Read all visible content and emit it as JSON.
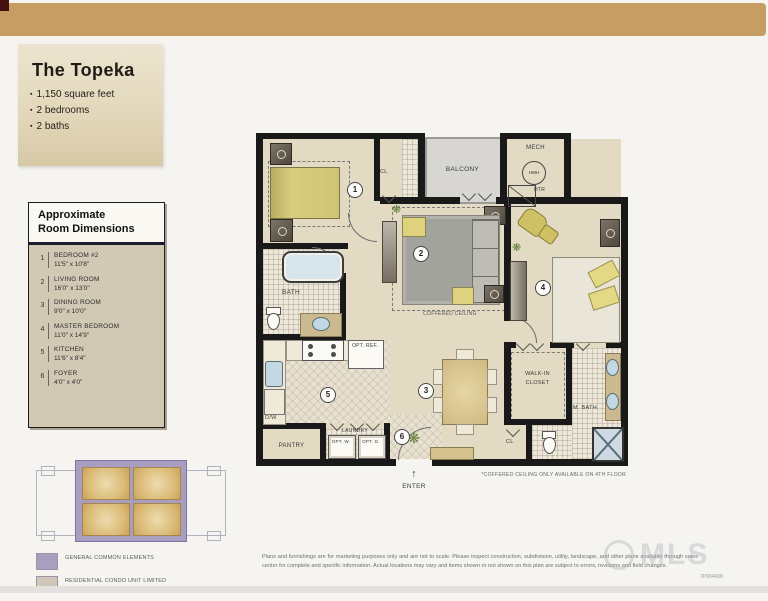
{
  "page": {
    "top_bar_color": "#c69e63",
    "watermark": "MLS",
    "doc_code": "7P904668"
  },
  "title_block": {
    "title": "The Topeka",
    "bullet_glyph": "▪",
    "bullets": [
      "1,150 square feet",
      "2 bedrooms",
      "2 baths"
    ]
  },
  "dimensions_panel": {
    "heading_line1": "Approximate",
    "heading_line2": "Room Dimensions",
    "items": [
      {
        "num": "1",
        "name": "BEDROOM #2",
        "size": "11'5\" x 10'8\""
      },
      {
        "num": "2",
        "name": "LIVING ROOM",
        "size": "16'0\" x 13'0\""
      },
      {
        "num": "3",
        "name": "DINING ROOM",
        "size": "9'0\" x 10'0\""
      },
      {
        "num": "4",
        "name": "MASTER BEDROOM",
        "size": "11'0\" x 14'9\""
      },
      {
        "num": "5",
        "name": "KITCHEN",
        "size": "11'6\" x 8'4\""
      },
      {
        "num": "6",
        "name": "FOYER",
        "size": "4'0\" x 4'0\""
      }
    ]
  },
  "plan": {
    "markers": [
      "1",
      "2",
      "3",
      "4",
      "5",
      "6"
    ],
    "labels": {
      "balcony": "BALCONY",
      "mech": "MECH",
      "hwh": "HWH",
      "htr": "HTR",
      "cl_top": "CL",
      "cl_bottom": "CL",
      "bath": "BATH",
      "opt_ref": "OPT. REF.",
      "dw": "D/W",
      "pantry": "PANTRY",
      "laundry": "LAUNDRY",
      "opt_w": "OPT. W.",
      "opt_d": "OPT. D.",
      "walk_in_line1": "WALK-IN",
      "walk_in_line2": "CLOSET",
      "m_bath": "M. BATH",
      "coffered_ceiling": "COFFERED CEILING",
      "enter": "ENTER",
      "enter_arrow": "↑",
      "footnote": "*COFFERED CEILING ONLY AVAILABLE ON 4TH FLOOR"
    }
  },
  "key_plan": {
    "legend": [
      {
        "line1": "GENERAL COMMON ELEMENTS",
        "line2": "",
        "color": "#a79ec0"
      },
      {
        "line1": "RESIDENTIAL CONDO UNIT LIMITED",
        "line2": "COMMON ELEMENTS",
        "color": "#cfc8b8"
      }
    ]
  },
  "disclaimer": "Plans and furnishings are for marketing purposes only and are not to scale. Please inspect construction, subdivision, utility, landscape, and other plans available through sales center for complete and specific information. Actual locations may vary and items shown or not shown on this plan are subject to errors, revisions and field changes."
}
